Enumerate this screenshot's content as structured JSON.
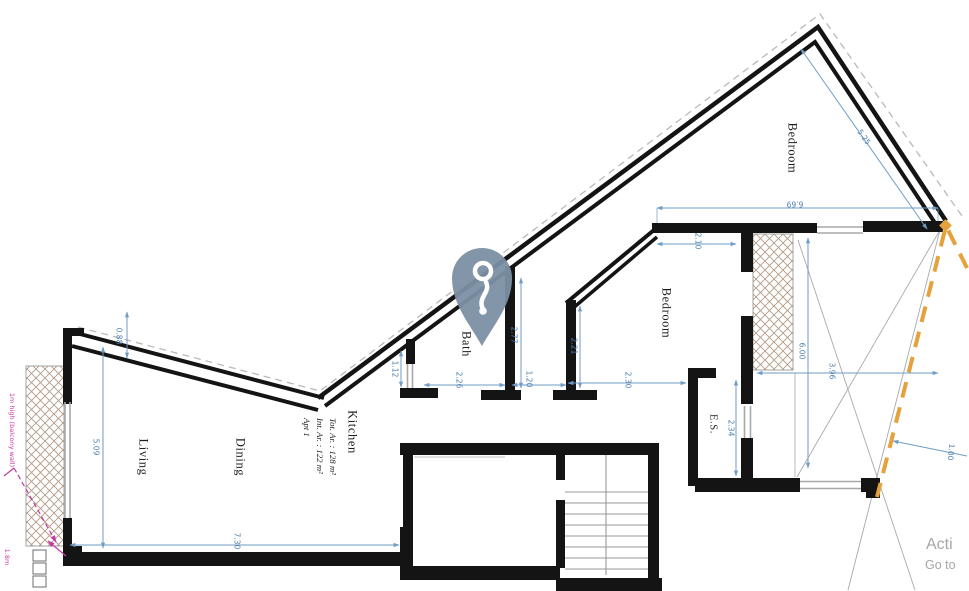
{
  "canvas": {
    "width": 969,
    "height": 591
  },
  "colors": {
    "wall": "#141414",
    "dimension": "#6f9dc6",
    "dimension_text": "#4d7fae",
    "hatch": "#b39a84",
    "orange_dashed": "#e5a13c",
    "magenta": "#c439a3",
    "pin": "#7c90a4",
    "watermark": "#a6a6a6",
    "stair_lines": "#9a9a9a"
  },
  "apartment": {
    "lines": [
      "Apt 1",
      "Int. Ar. : 122 m²",
      "Tot. Ar. : 128 m²"
    ]
  },
  "rooms": [
    {
      "id": "living",
      "label": "Living"
    },
    {
      "id": "dining",
      "label": "Dining"
    },
    {
      "id": "kitchen",
      "label": "Kitchen"
    },
    {
      "id": "bath",
      "label": "Bath"
    },
    {
      "id": "bedroom_main",
      "label": "Bedroom"
    },
    {
      "id": "bedroom_top",
      "label": "Bedroom"
    },
    {
      "id": "ensuite",
      "label": "E.S."
    }
  ],
  "dimensions": {
    "d088": "0.88",
    "d509": "5.09",
    "d730": "7.30",
    "d112": "1.12",
    "d226": "2.26",
    "d277": "2.77",
    "d120": "1.20",
    "d221": "2.21",
    "d230": "2.30",
    "d210": "2.10",
    "d234": "2.34",
    "d600": "6.00",
    "d669": "6.69",
    "d525": "5.25",
    "d396": "3.96",
    "d100": "1.00"
  },
  "annotations": {
    "balcony_wall": "1m high (balcony wall)",
    "bottom_left": "1.8m"
  },
  "marker": {
    "icon": "key-location-pin"
  },
  "watermark": {
    "line1": "Acti",
    "line2": "Go to"
  }
}
